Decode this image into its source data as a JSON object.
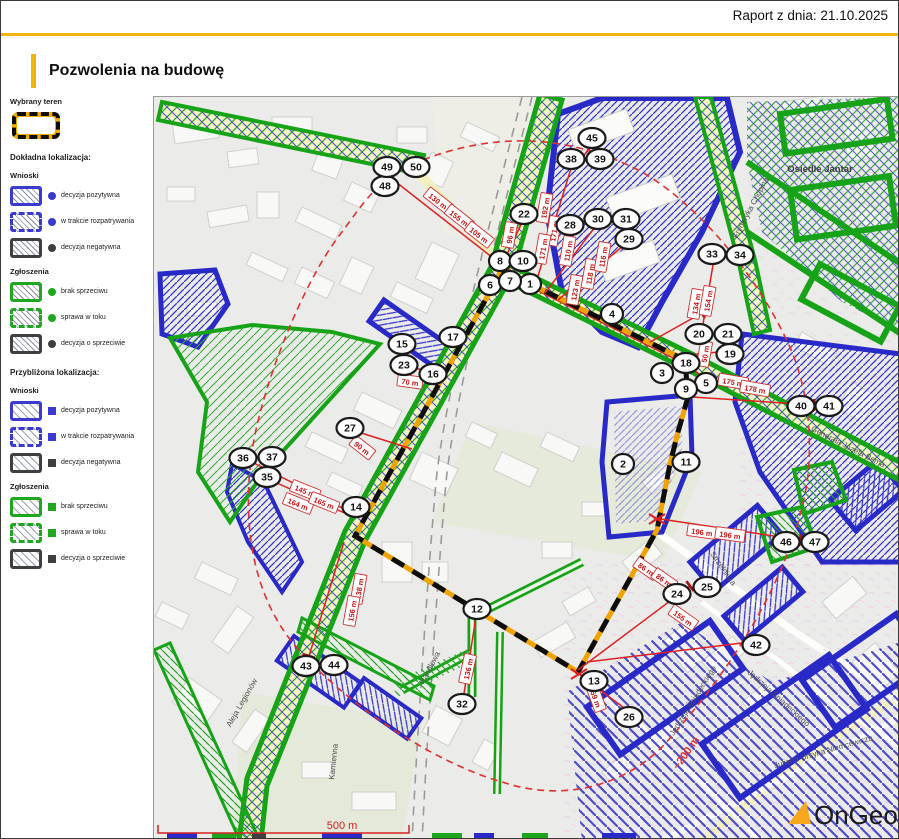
{
  "header": {
    "report_date": "Raport z dnia: 21.10.2025",
    "title": "Pozwolenia na budowę"
  },
  "legend": {
    "selected_area_label": "Wybrany teren",
    "sections": [
      {
        "title": "Dokładna lokalizacja:",
        "marker": "dot",
        "approx": false,
        "groups": [
          {
            "name": "Wnioski",
            "items": [
              {
                "label": "decyzja pozytywna",
                "color": "#3a3ad1",
                "border": "solid"
              },
              {
                "label": "w trakcie rozpatrywania",
                "color": "#3a3ad1",
                "border": "dashed"
              },
              {
                "label": "decyzja negatywna",
                "color": "#3f3f3f",
                "border": "solid"
              }
            ]
          },
          {
            "name": "Zgłoszenia",
            "items": [
              {
                "label": "brak sprzeciwu",
                "color": "#1fa81f",
                "border": "solid"
              },
              {
                "label": "sprawa w toku",
                "color": "#1fa81f",
                "border": "dashed"
              },
              {
                "label": "decyzja o sprzeciwie",
                "color": "#3f3f3f",
                "border": "solid"
              }
            ]
          }
        ]
      },
      {
        "title": "Przybliżona lokalizacja:",
        "marker": "square",
        "approx": true,
        "groups": [
          {
            "name": "Wnioski",
            "items": [
              {
                "label": "decyzja pozytywna",
                "color": "#3a3ad1",
                "border": "solid"
              },
              {
                "label": "w trakcie rozpatrywania",
                "color": "#3a3ad1",
                "border": "dashed"
              },
              {
                "label": "decyzja negatywna",
                "color": "#3f3f3f",
                "border": "solid"
              }
            ]
          },
          {
            "name": "Zgłoszenia",
            "items": [
              {
                "label": "brak sprzeciwu",
                "color": "#1fa81f",
                "border": "solid"
              },
              {
                "label": "sprawa w toku",
                "color": "#1fa81f",
                "border": "dashed"
              },
              {
                "label": "decyzja o sprzeciwie",
                "color": "#3f3f3f",
                "border": "solid"
              }
            ]
          }
        ]
      }
    ]
  },
  "map": {
    "markers": [
      {
        "n": 1,
        "x": 528,
        "y": 282
      },
      {
        "n": 2,
        "x": 621,
        "y": 462
      },
      {
        "n": 3,
        "x": 660,
        "y": 371
      },
      {
        "n": 4,
        "x": 610,
        "y": 312
      },
      {
        "n": 5,
        "x": 704,
        "y": 381
      },
      {
        "n": 6,
        "x": 488,
        "y": 283
      },
      {
        "n": 7,
        "x": 508,
        "y": 279
      },
      {
        "n": 8,
        "x": 498,
        "y": 259
      },
      {
        "n": 9,
        "x": 684,
        "y": 387
      },
      {
        "n": 10,
        "x": 521,
        "y": 259
      },
      {
        "n": 11,
        "x": 684,
        "y": 460
      },
      {
        "n": 12,
        "x": 475,
        "y": 607
      },
      {
        "n": 13,
        "x": 592,
        "y": 679
      },
      {
        "n": 14,
        "x": 354,
        "y": 505
      },
      {
        "n": 15,
        "x": 400,
        "y": 342
      },
      {
        "n": 16,
        "x": 431,
        "y": 372
      },
      {
        "n": 17,
        "x": 451,
        "y": 335
      },
      {
        "n": 18,
        "x": 684,
        "y": 361
      },
      {
        "n": 19,
        "x": 728,
        "y": 352
      },
      {
        "n": 20,
        "x": 697,
        "y": 332
      },
      {
        "n": 21,
        "x": 726,
        "y": 332
      },
      {
        "n": 22,
        "x": 522,
        "y": 212
      },
      {
        "n": 23,
        "x": 402,
        "y": 363
      },
      {
        "n": 24,
        "x": 675,
        "y": 592
      },
      {
        "n": 25,
        "x": 705,
        "y": 585
      },
      {
        "n": 26,
        "x": 627,
        "y": 715
      },
      {
        "n": 27,
        "x": 348,
        "y": 426
      },
      {
        "n": 28,
        "x": 568,
        "y": 223
      },
      {
        "n": 29,
        "x": 627,
        "y": 237
      },
      {
        "n": 30,
        "x": 596,
        "y": 217
      },
      {
        "n": 31,
        "x": 624,
        "y": 217
      },
      {
        "n": 32,
        "x": 460,
        "y": 702
      },
      {
        "n": 33,
        "x": 710,
        "y": 252
      },
      {
        "n": 34,
        "x": 738,
        "y": 253
      },
      {
        "n": 35,
        "x": 265,
        "y": 475
      },
      {
        "n": 36,
        "x": 241,
        "y": 456
      },
      {
        "n": 37,
        "x": 270,
        "y": 455
      },
      {
        "n": 38,
        "x": 569,
        "y": 157
      },
      {
        "n": 39,
        "x": 598,
        "y": 157
      },
      {
        "n": 40,
        "x": 799,
        "y": 404
      },
      {
        "n": 41,
        "x": 827,
        "y": 404
      },
      {
        "n": 42,
        "x": 754,
        "y": 643
      },
      {
        "n": 43,
        "x": 304,
        "y": 664
      },
      {
        "n": 44,
        "x": 332,
        "y": 663
      },
      {
        "n": 45,
        "x": 590,
        "y": 136
      },
      {
        "n": 46,
        "x": 784,
        "y": 540
      },
      {
        "n": 47,
        "x": 813,
        "y": 540
      },
      {
        "n": 48,
        "x": 383,
        "y": 184
      },
      {
        "n": 49,
        "x": 385,
        "y": 165
      },
      {
        "n": 50,
        "x": 414,
        "y": 165
      }
    ],
    "streets": [
      {
        "name": "Osiedle Jantar",
        "x": 818,
        "y": 170,
        "rot": 0,
        "big": true
      },
      {
        "name": "Fryderyka Chopina",
        "x": 751,
        "y": 207,
        "rot": -62,
        "big": false
      },
      {
        "name": "Generała Józefa Bema",
        "x": 845,
        "y": 447,
        "rot": 27,
        "big": false
      },
      {
        "name": "Strzelnicza",
        "x": 719,
        "y": 568,
        "rot": 55,
        "big": false
      },
      {
        "name": "Jędrzeja Śniadeckiego",
        "x": 693,
        "y": 700,
        "rot": -58,
        "big": false
      },
      {
        "name": "Jędrzeja Śniadeckiego",
        "x": 775,
        "y": 698,
        "rot": 42,
        "big": false
      },
      {
        "name": "Juliana Ursyna Niemcewicza",
        "x": 822,
        "y": 752,
        "rot": -16,
        "big": false
      },
      {
        "name": "Aleja Legionów",
        "x": 242,
        "y": 702,
        "rot": -60,
        "big": false
      },
      {
        "name": "Kamienna",
        "x": 334,
        "y": 760,
        "rot": -84,
        "big": false
      },
      {
        "name": "Handlowa",
        "x": 430,
        "y": 667,
        "rot": -62,
        "big": false
      }
    ],
    "measurements": [
      {
        "text": "130 m",
        "x": 436,
        "y": 199,
        "rot": 38
      },
      {
        "text": "155 m",
        "x": 457,
        "y": 216,
        "rot": 38
      },
      {
        "text": "105 m",
        "x": 477,
        "y": 233,
        "rot": 38
      },
      {
        "text": "96 m",
        "x": 508,
        "y": 233,
        "rot": -80
      },
      {
        "text": "192 m",
        "x": 543,
        "y": 206,
        "rot": -80
      },
      {
        "text": "171 m",
        "x": 552,
        "y": 229,
        "rot": -80
      },
      {
        "text": "171 m",
        "x": 541,
        "y": 247,
        "rot": -80
      },
      {
        "text": "110 m",
        "x": 566,
        "y": 249,
        "rot": -80
      },
      {
        "text": "123 m",
        "x": 573,
        "y": 288,
        "rot": -80
      },
      {
        "text": "118 m",
        "x": 588,
        "y": 272,
        "rot": -80
      },
      {
        "text": "116 m",
        "x": 601,
        "y": 255,
        "rot": -80
      },
      {
        "text": "134 m",
        "x": 694,
        "y": 302,
        "rot": -80
      },
      {
        "text": "154 m",
        "x": 706,
        "y": 299,
        "rot": -80
      },
      {
        "text": "50 m",
        "x": 703,
        "y": 352,
        "rot": -80
      },
      {
        "text": "175 m",
        "x": 731,
        "y": 380,
        "rot": 10
      },
      {
        "text": "178 m",
        "x": 753,
        "y": 387,
        "rot": 10
      },
      {
        "text": "196 m",
        "x": 700,
        "y": 530,
        "rot": 8
      },
      {
        "text": "196 m",
        "x": 728,
        "y": 533,
        "rot": 8
      },
      {
        "text": "86 m",
        "x": 644,
        "y": 567,
        "rot": 35
      },
      {
        "text": "86 m",
        "x": 662,
        "y": 578,
        "rot": 35
      },
      {
        "text": "155 m",
        "x": 681,
        "y": 616,
        "rot": 35
      },
      {
        "text": "59 m",
        "x": 594,
        "y": 697,
        "rot": 70
      },
      {
        "text": "136 m",
        "x": 466,
        "y": 667,
        "rot": -78
      },
      {
        "text": "138 m",
        "x": 357,
        "y": 587,
        "rot": -80
      },
      {
        "text": "156 m",
        "x": 350,
        "y": 609,
        "rot": -80
      },
      {
        "text": "90 m",
        "x": 360,
        "y": 446,
        "rot": 38
      },
      {
        "text": "70 m",
        "x": 408,
        "y": 380,
        "rot": 8
      },
      {
        "text": "145 m",
        "x": 303,
        "y": 489,
        "rot": 22
      },
      {
        "text": "164 m",
        "x": 296,
        "y": 502,
        "rot": 22
      },
      {
        "text": "165 m",
        "x": 322,
        "y": 501,
        "rot": 22
      }
    ],
    "lines": [
      [
        500,
        263,
        385,
        173
      ],
      [
        500,
        263,
        522,
        216
      ],
      [
        532,
        287,
        570,
        163
      ],
      [
        543,
        291,
        596,
        221
      ],
      [
        556,
        298,
        627,
        239
      ],
      [
        648,
        340,
        700,
        311
      ],
      [
        676,
        354,
        727,
        349
      ],
      [
        686,
        363,
        704,
        378
      ],
      [
        690,
        395,
        812,
        403
      ],
      [
        652,
        516,
        798,
        538
      ],
      [
        576,
        668,
        688,
        584
      ],
      [
        585,
        660,
        748,
        640
      ],
      [
        577,
        672,
        630,
        712
      ],
      [
        475,
        608,
        461,
        698
      ],
      [
        410,
        447,
        353,
        429
      ],
      [
        438,
        372,
        404,
        364
      ],
      [
        352,
        512,
        248,
        459
      ],
      [
        354,
        516,
        268,
        478
      ],
      [
        342,
        540,
        307,
        654
      ],
      [
        700,
        328,
        712,
        257
      ],
      [
        575,
        165,
        590,
        141
      ]
    ],
    "x_marks": [
      [
        500,
        263
      ],
      [
        655,
        517
      ],
      [
        577,
        672
      ],
      [
        686,
        362
      ]
    ],
    "buffer_label": {
      "text": "~200 m",
      "x": 687,
      "y": 753,
      "rot": -55
    },
    "scale_bar": {
      "label": "500 m"
    },
    "logo": {
      "text": "OnGeo"
    }
  },
  "colors": {
    "accent_yellow": "#f2b50d",
    "permit_blue": "#2f2fc9",
    "notice_green": "#1da51d",
    "negative_dark": "#3f3f3f",
    "measure_red": "#c41414",
    "boundary_orange": "#f0a300"
  }
}
